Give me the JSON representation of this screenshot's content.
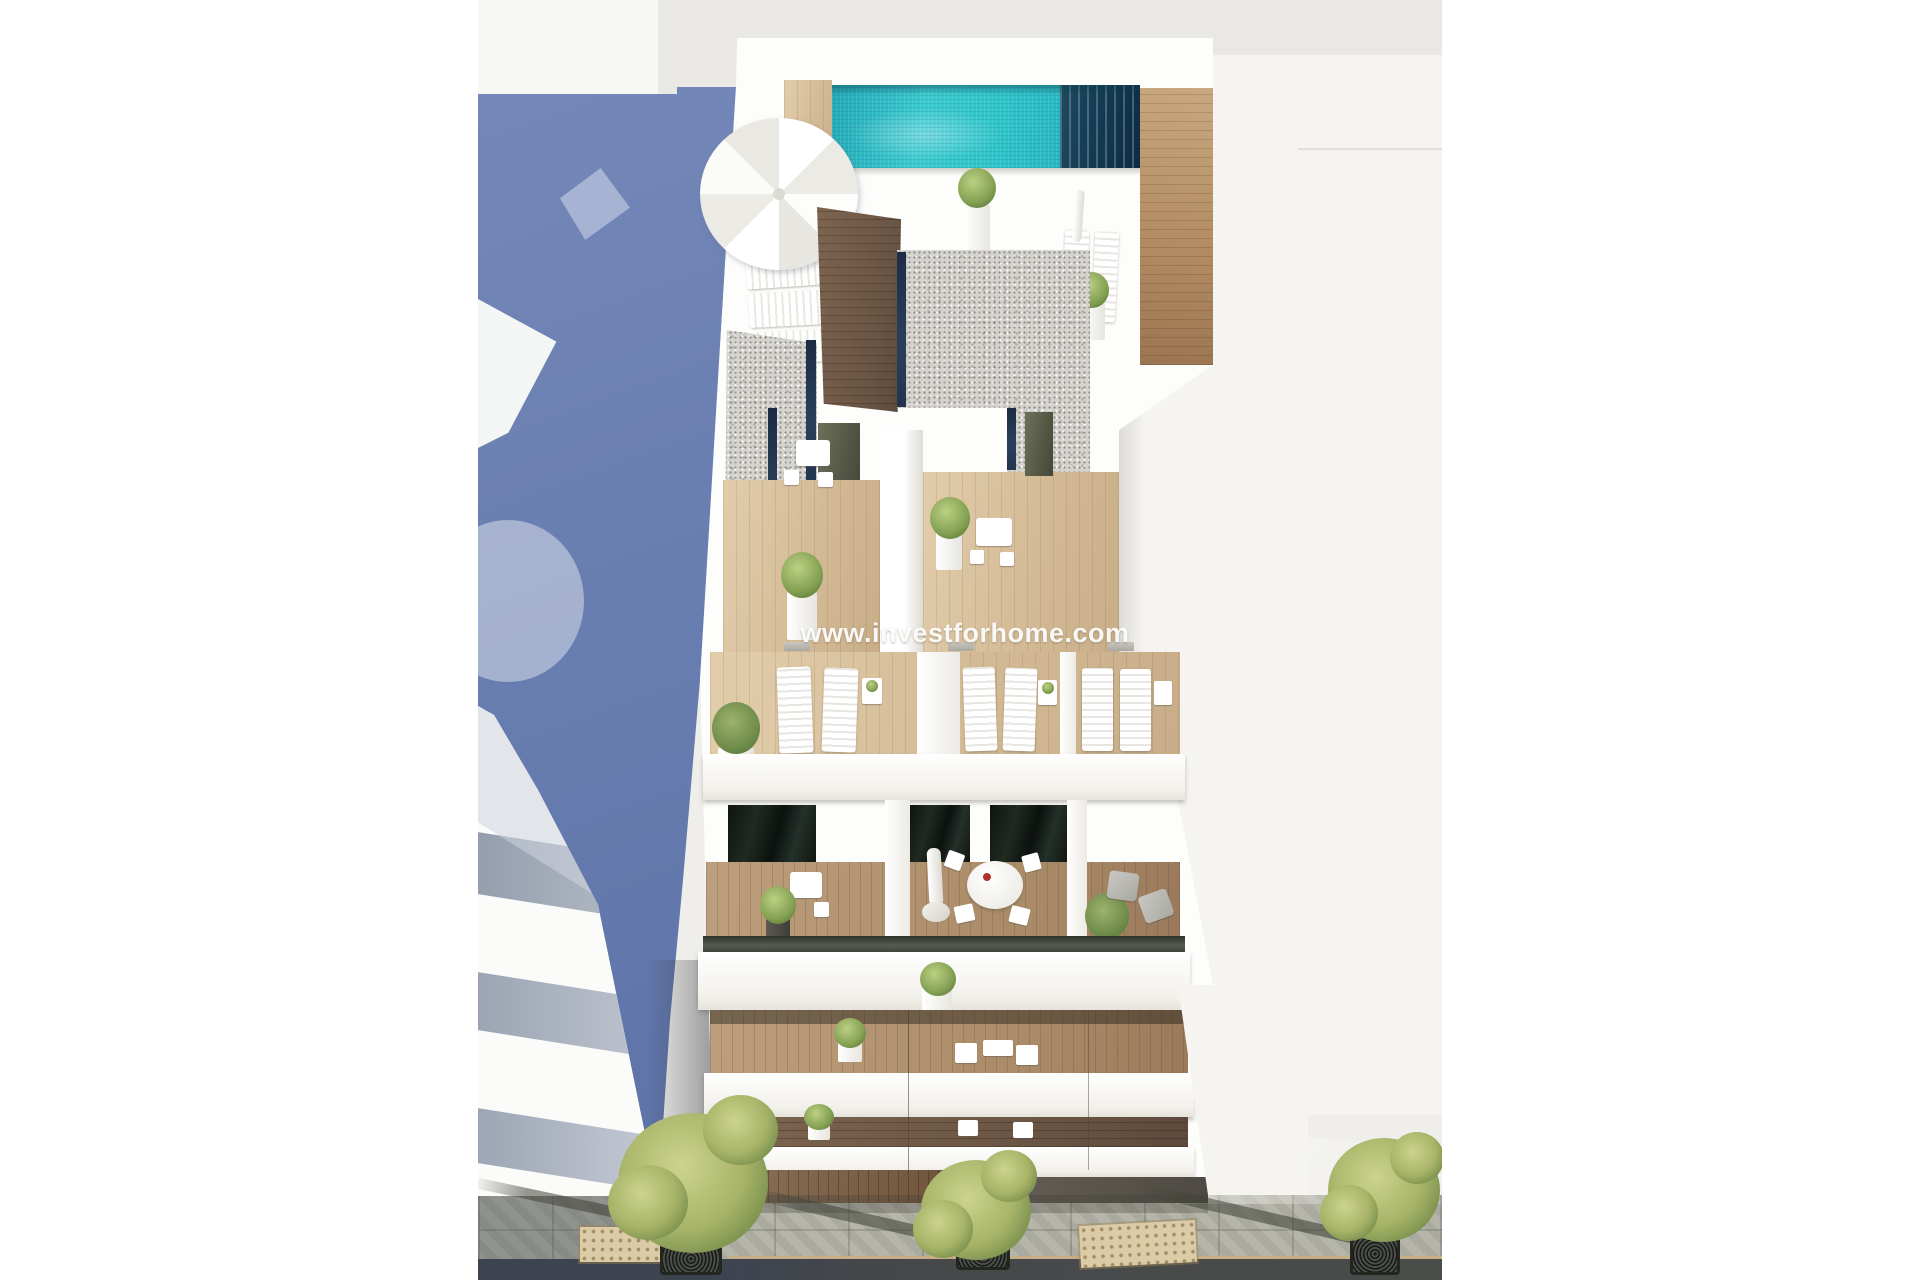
{
  "watermark": {
    "text": "www.investforhome.com",
    "color": "#ffffff"
  },
  "scene": {
    "type": "architectural-3d-render",
    "subject": "Aerial view of a modern white apartment building with rooftop pool, terraces, balconies and street below",
    "elements": [
      "rooftop-swimming-pool",
      "pool-parasol",
      "sun-loungers",
      "gravel-roof-sections",
      "wood-deck-terraces",
      "potted-plants",
      "terrace-dining-sets",
      "balcony-glass-railings",
      "closed-parasol",
      "armchairs",
      "street-sidewalk",
      "street-trees",
      "tree-grates",
      "tactile-paving-mats",
      "neighboring-building",
      "shadowed-side-passage"
    ]
  },
  "palette": {
    "page_background": "#ffffff",
    "backdrop_gray": "#e9e8e4",
    "neighbor_roof": "#f5f4f0",
    "shadow_blue": "#6b80b2",
    "pool_turquoise": "#30c4ca",
    "pool_navy": "#17394e",
    "wood_light": "#d9c2a2",
    "wood_mid": "#a98a67",
    "wood_dark": "#6a5443",
    "gravel_gray": "#d5d3ce",
    "skylight_navy": "#24354d",
    "glass_dark": "#1c231e",
    "street_gray": "#b1b1a6",
    "tree_green": "#a7b468",
    "tactile_beige": "#dbcba6"
  }
}
